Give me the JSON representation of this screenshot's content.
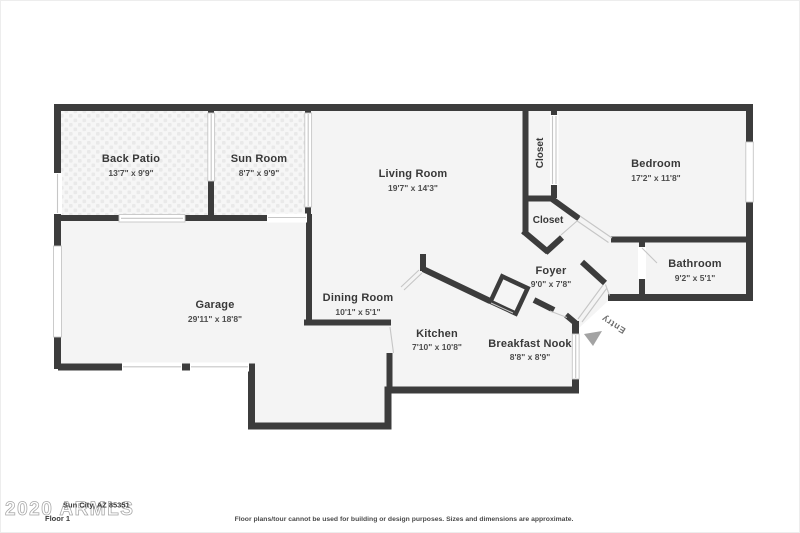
{
  "colors": {
    "wall": "#3c3c3c",
    "floor": "#f4f4f4",
    "window": "#c6c6c6",
    "entry_arrow": "#a3a3a3"
  },
  "rooms": {
    "back_patio": {
      "name": "Back Patio",
      "dims": "13'7\" x 9'9\""
    },
    "sun_room": {
      "name": "Sun Room",
      "dims": "8'7\" x 9'9\""
    },
    "living_room": {
      "name": "Living Room",
      "dims": "19'7\" x 14'3\""
    },
    "closet_upper": {
      "name": "Closet"
    },
    "bedroom": {
      "name": "Bedroom",
      "dims": "17'2\" x 11'8\""
    },
    "closet_lower": {
      "name": "Closet"
    },
    "bathroom": {
      "name": "Bathroom",
      "dims": "9'2\" x 5'1\""
    },
    "foyer": {
      "name": "Foyer",
      "dims": "9'0\" x 7'8\""
    },
    "dining_room": {
      "name": "Dining Room",
      "dims": "10'1\" x 5'1\""
    },
    "garage": {
      "name": "Garage",
      "dims": "29'11\" x 18'8\""
    },
    "kitchen": {
      "name": "Kitchen",
      "dims": "7'10\" x 10'8\""
    },
    "breakfast_nook": {
      "name": "Breakfast Nook",
      "dims": "8'8\" x 8'9\""
    },
    "entry": {
      "name": "Entry"
    }
  },
  "footer": {
    "watermark": "2020 ARMLS",
    "address": "Sun City, AZ 85351",
    "floor_label": "Floor 1",
    "disclaimer": "Floor plans/tour cannot be used for building or design purposes. Sizes and dimensions are approximate."
  }
}
